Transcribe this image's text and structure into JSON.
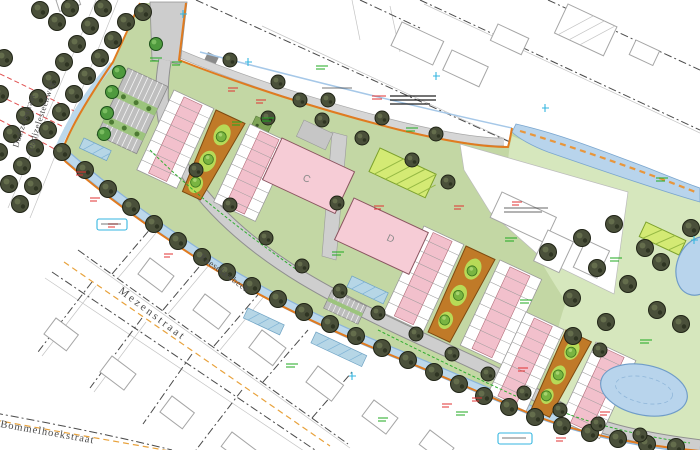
{
  "map": {
    "streets": {
      "mezenstraat": "Mezenstraat",
      "bommelhoekstraat": "Bommelhoekstraat",
      "dadizelesteenweg": "Dadizelesteenweg",
      "dadizelestraat": "Dadizelestraat"
    },
    "waterway": {
      "roeselarebeek": "Roeselarebeek"
    },
    "blocks": {
      "c": "C",
      "d": "D"
    },
    "colors": {
      "site_green": "#c3d7a4",
      "park_green": "#d6e7bd",
      "block_pink": "#f6ccd6",
      "house_pink": "#f2c0cc",
      "play_orange": "#c07a28",
      "lime_green": "#b7da57",
      "water_blue": "#b8d4ec",
      "boundary_orange": "#e07b20",
      "road_gray": "#cecece",
      "tree_dark": "#4a503a",
      "tree_green": "#4f9a3e",
      "annotation_red": "#e03030",
      "annotation_green": "#1faa1f",
      "annotation_cyan": "#35b6e0"
    }
  }
}
